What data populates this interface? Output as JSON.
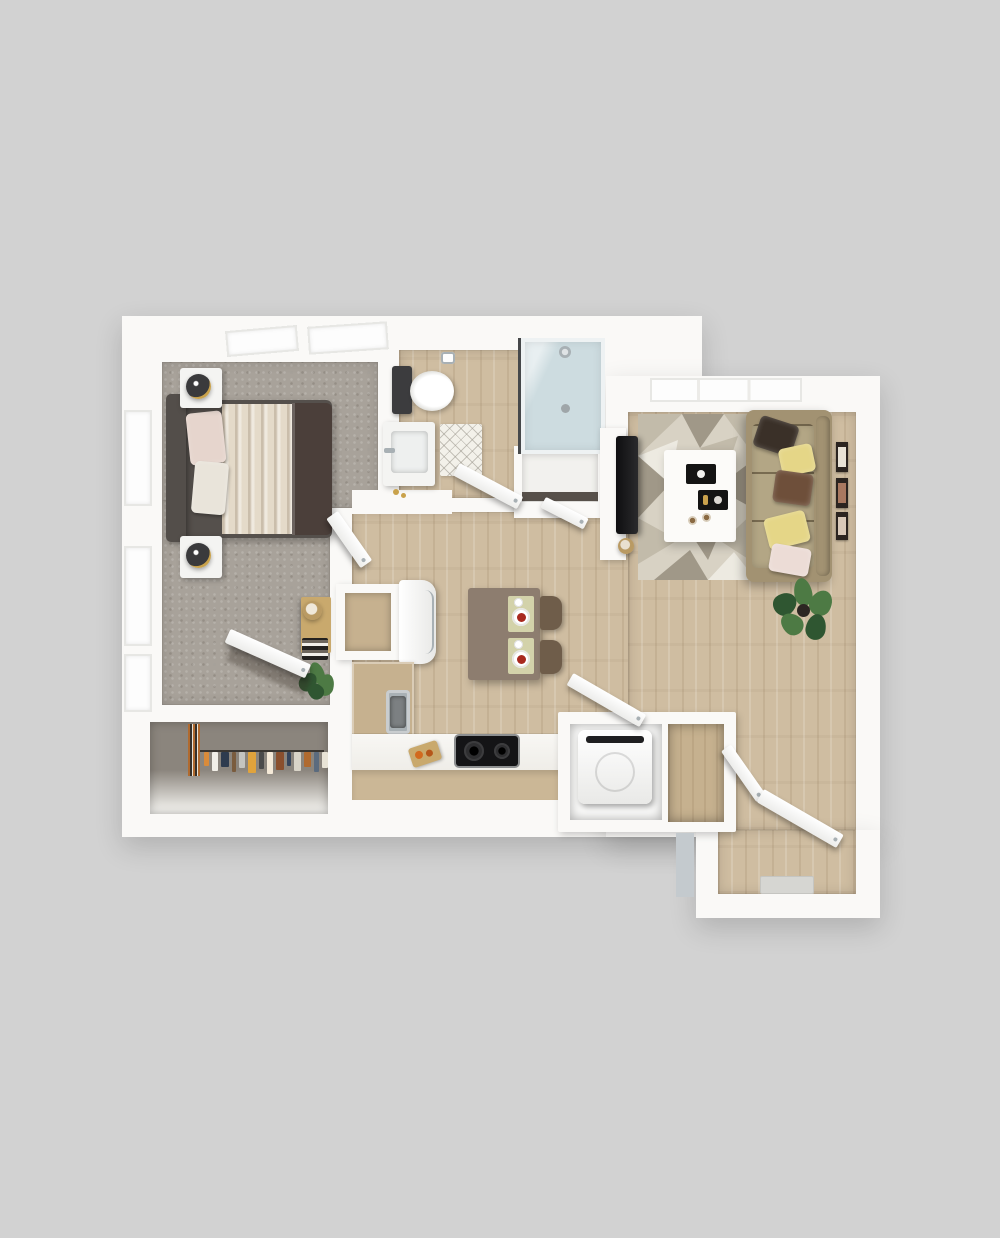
{
  "meta": {
    "description": "3D top-down rendering of a one-bedroom, one-bath apartment floor plan on a gray background. No text labels are visible in the image."
  },
  "palette": {
    "bg": "#d2d2d2",
    "wall": "#faf9f7",
    "wallEdge": "#e4e2de",
    "carpet": "#a8a29a",
    "carpetDark": "#8b857d",
    "wood": "#cfbda1",
    "counter": "#c6b18f",
    "counterFace": "#cbb796",
    "table": "#8d7d6f",
    "chair": "#6f5d4a",
    "matSage": "#d3d2aa",
    "foodRed": "#a8291f",
    "sofa": "#a29272",
    "sofaCushion": "#b3a685",
    "pilDark": "#3a3028",
    "pilYellow": "#e5d687",
    "pilBrown": "#6e4f3a",
    "pilBlush": "#ecdcd6",
    "rug0": "#d8d2c4",
    "rug1": "#c2bbaa",
    "rug2": "#a09888",
    "rug3": "#edeae1",
    "headboard": "#534e4a",
    "duvet": "#4b3f3a",
    "blanket": "#e4dac9",
    "bedPillow": "#e6d5cd",
    "tv": "#2a2a2c",
    "plant": "#4d7a44",
    "plantDark": "#2f5631",
    "glass": "#cddce0",
    "chrome": "#a8b0b4",
    "gold": "#c9a24b",
    "stove": "#141416",
    "applianceWhite": "#f4f4f2",
    "matGray": "#d6d6d2",
    "grayWallFace": "#c4cace",
    "shelfDark": "#57504a",
    "woodDesk": "#c9a96d"
  },
  "rooms": [
    {
      "id": "bedroom",
      "label": "Bedroom",
      "flooring": "carpet"
    },
    {
      "id": "closet",
      "label": "Reach-in closet",
      "flooring": "carpet"
    },
    {
      "id": "bathroom",
      "label": "Bathroom",
      "flooring": "wood"
    },
    {
      "id": "kitchen",
      "label": "Kitchen / dining",
      "flooring": "wood"
    },
    {
      "id": "living-room",
      "label": "Living room",
      "flooring": "wood"
    },
    {
      "id": "laundry",
      "label": "Laundry closet",
      "flooring": "wood"
    },
    {
      "id": "entry",
      "label": "Entry",
      "flooring": "wood"
    }
  ],
  "furniture": {
    "bedroom": [
      "bed with dark duvet and cream blanket",
      "upholstered headboard",
      "nightstand with lamp (x2)",
      "desk with stool",
      "magazine rack",
      "potted plant",
      "three windows",
      "two skylight panels"
    ],
    "closet": [
      "hanging clothes on rod"
    ],
    "bathroom": [
      "toilet",
      "vanity sink",
      "diamond-pattern bath mat",
      "glass shower",
      "towel ring",
      "linen closet with shelf"
    ],
    "kitchen": [
      "refrigerator",
      "open pantry cabinet",
      "L-shaped counter",
      "sink",
      "two-burner cooktop",
      "cutting board",
      "dining table with two place settings",
      "two chairs"
    ],
    "living_room": [
      "sofa with five pillows",
      "geometric area rug",
      "coffee table with two trays and two cups",
      "wall-mounted TV on half wall",
      "round stool",
      "potted plant",
      "three wall art frames",
      "window"
    ],
    "laundry": [
      "top-load washer",
      "bifold door",
      "coat closet"
    ],
    "entry": [
      "open entry door",
      "door mat"
    ]
  },
  "closet": {
    "clothes": [
      "#d98b3a",
      "#f2efe8",
      "#2e3b4e",
      "#7a5c3e",
      "#c4c4bf",
      "#e0a33c",
      "#4a4a4a",
      "#f4e9d8",
      "#8a4f2d",
      "#36455c",
      "#d9d4c8",
      "#b06a2f",
      "#5b6b7e",
      "#e8e3d6"
    ]
  }
}
